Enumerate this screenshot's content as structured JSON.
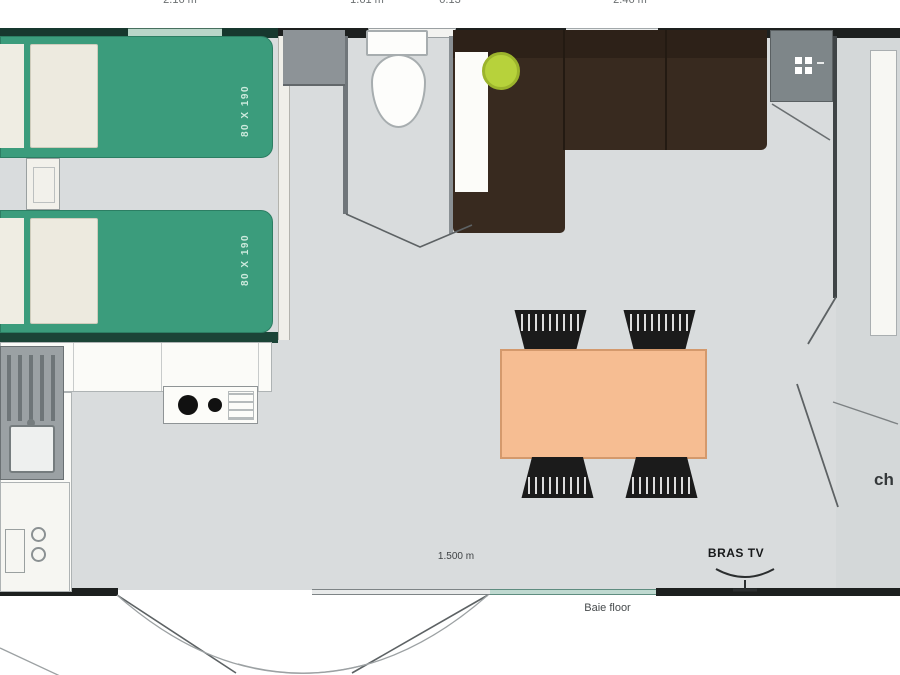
{
  "plan": {
    "dimensions_top": [
      {
        "text": "2.16 m"
      },
      {
        "text": "1.61 m"
      },
      {
        "text": "0.13"
      },
      {
        "text": "2.46 m"
      }
    ],
    "beds": {
      "bed1_label": "80 X 190",
      "bed2_label": "80 X 190"
    },
    "annotations": {
      "bay_width": "1.500 m",
      "tv_bracket": "BRAS TV",
      "bay_door": "Baie floor",
      "partial_right": "ch"
    },
    "colors": {
      "floor": "#d9dcdd",
      "wall": "#1d201f",
      "wall_green": "#17382e",
      "bed_green": "#3b9c7c",
      "pillow": "#edeadf",
      "sofa_brown": "#382a1f",
      "cushion_lime": "#b7d23b",
      "table_peach": "#f6bd92",
      "chair_black": "#1b1b1b",
      "appliance_gray": "#8d9397"
    }
  }
}
